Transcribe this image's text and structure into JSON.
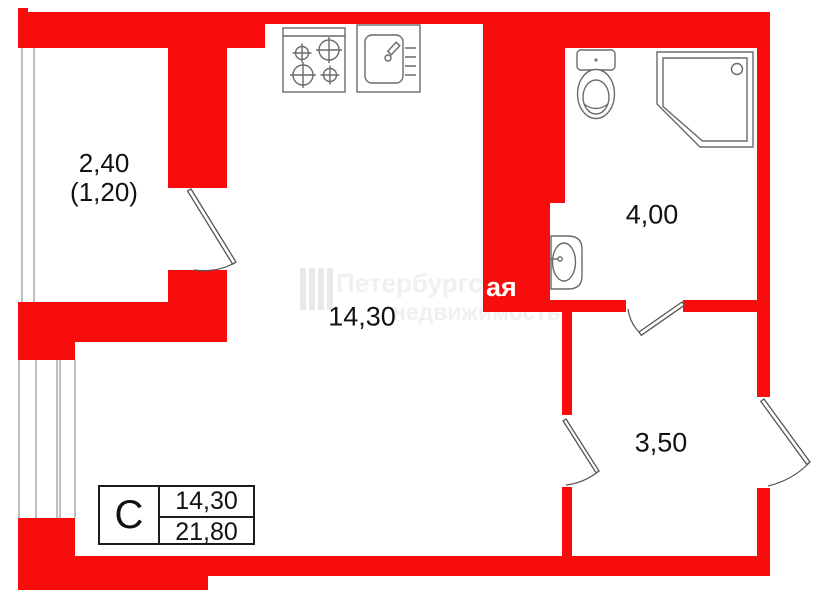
{
  "rooms": {
    "balcony": {
      "area": "2,40",
      "secondary": "(1,20)"
    },
    "living_kitchen": {
      "area": "14,30"
    },
    "bathroom": {
      "area": "4,00"
    },
    "hallway": {
      "area": "3,50"
    }
  },
  "summary": {
    "type": "С",
    "living_area": "14,30",
    "total_area": "21,80"
  },
  "watermark": {
    "brand_line1": "Петербургская",
    "brand_line2": "недвижимость",
    "wall_fragment": "ая"
  },
  "colors": {
    "wall_red": "#f80c0c",
    "line_gray": "#6a6a6a",
    "text_black": "#121212",
    "watermark_faint": "#f2efef",
    "watermark_on_wall": "#ffffff"
  }
}
